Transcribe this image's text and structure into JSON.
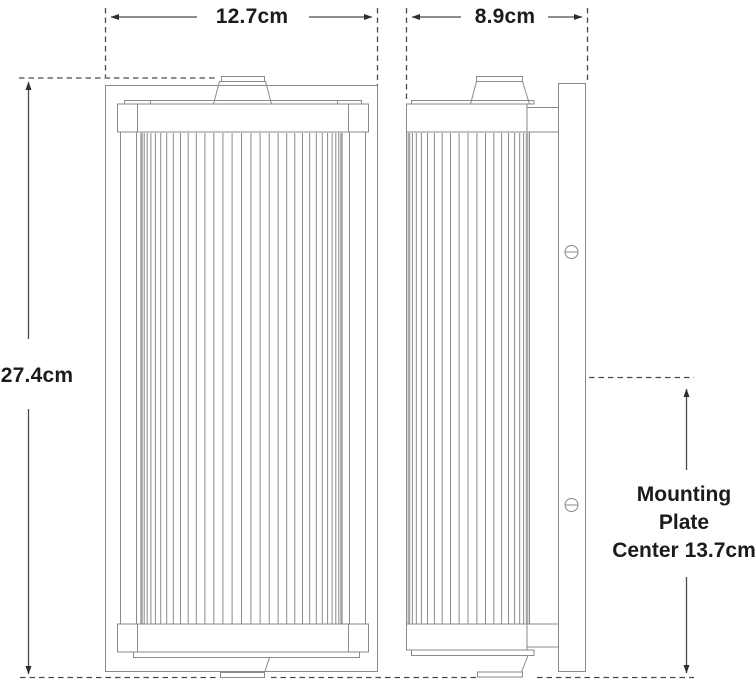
{
  "diagram": {
    "title": "wall-sconce-dimension-drawing",
    "views": [
      "front-view",
      "side-view"
    ],
    "colors": {
      "background": "#ffffff",
      "drawing_line": "#8a8a8a",
      "dimension_line": "#4a4a4a",
      "arrowhead": "#2e2e2e",
      "text": "#1b1b1b"
    }
  },
  "dimensions": {
    "front_width_label": "12.7cm",
    "side_depth_label": "8.9cm",
    "height_label": "27.4cm",
    "mounting_label": [
      "Mounting",
      "Plate",
      "Center 13.7cm"
    ]
  },
  "measurements": {
    "front_width_cm": 12.7,
    "side_depth_cm": 8.9,
    "height_cm": 27.4,
    "mounting_plate_center_cm": 13.7
  },
  "icons": {
    "screw": "slotted-screw-icon"
  }
}
